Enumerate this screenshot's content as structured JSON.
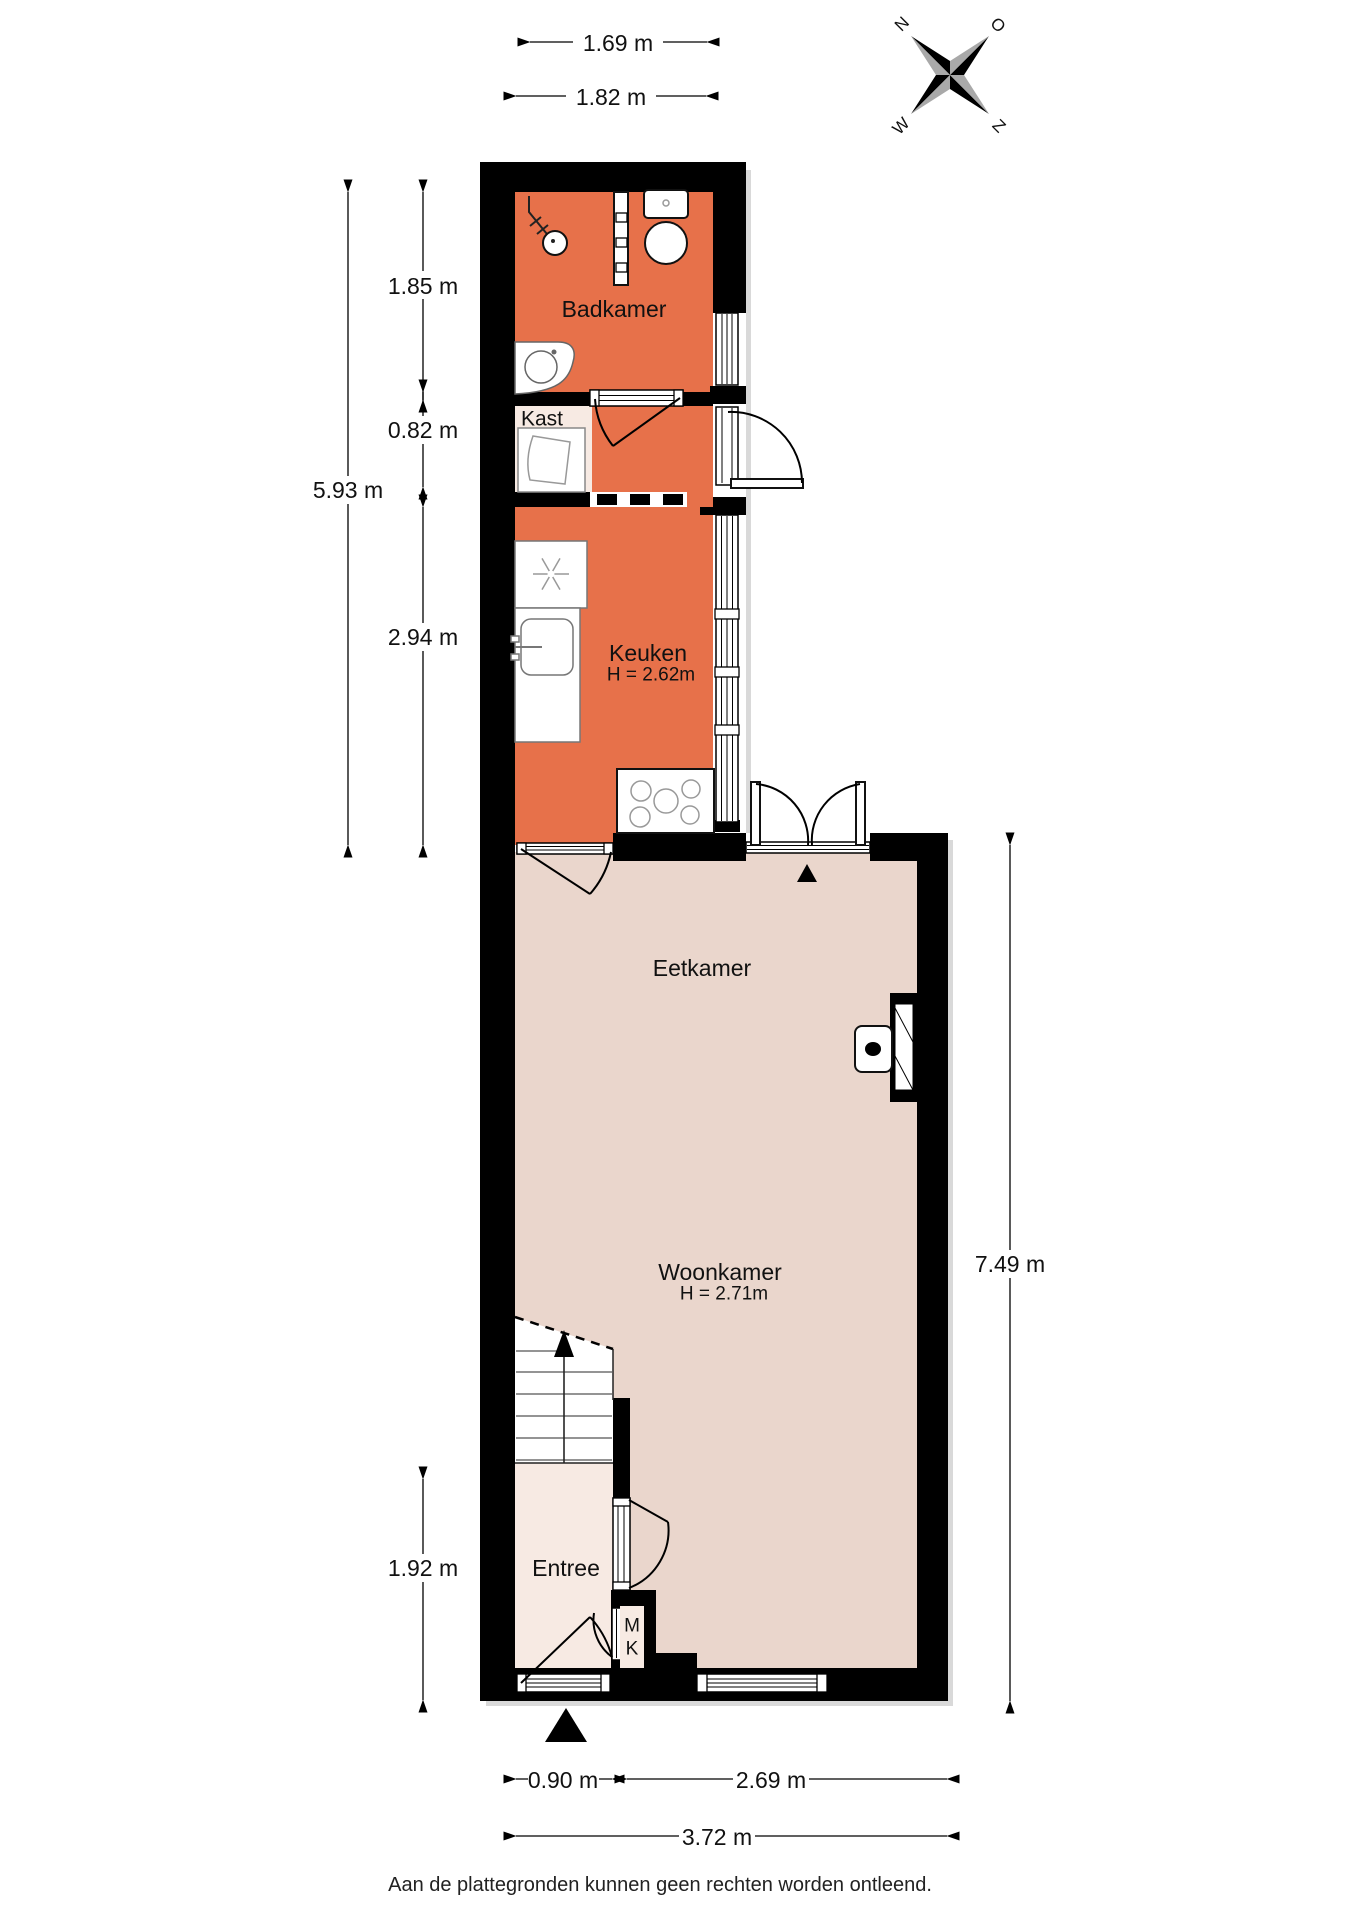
{
  "page": {
    "footer": "Aan de plattegronden kunnen geen rechten worden ontleend."
  },
  "colors": {
    "wall": "#000000",
    "room_warm": "#E7714A",
    "floor_main": "#EAD6CC",
    "floor_light": "#F7EAE3",
    "shadow": "#D9D9D9"
  },
  "compass": {
    "north": "N",
    "east": "O",
    "south": "Z",
    "west": "W"
  },
  "rooms": {
    "badkamer": {
      "label": "Badkamer"
    },
    "kast": {
      "label": "Kast"
    },
    "keuken": {
      "label": "Keuken",
      "height_label": "H = 2.62m"
    },
    "eetkamer": {
      "label": "Eetkamer"
    },
    "woonkamer": {
      "label": "Woonkamer",
      "height_label": "H = 2.71m"
    },
    "entree": {
      "label": "Entree"
    },
    "meterkast": {
      "line1": "M",
      "line2": "K"
    }
  },
  "dimensions": {
    "top_width_bathroom": "1.69 m",
    "top_width_overall": "1.82 m",
    "left_badkamer": "1.85 m",
    "left_kast": "0.82 m",
    "left_keuken": "2.94 m",
    "left_total_upper": "5.93 m",
    "left_entree": "1.92 m",
    "right_living": "7.49 m",
    "bottom_entrance": "0.90 m",
    "bottom_living": "2.69 m",
    "bottom_total": "3.72 m"
  }
}
